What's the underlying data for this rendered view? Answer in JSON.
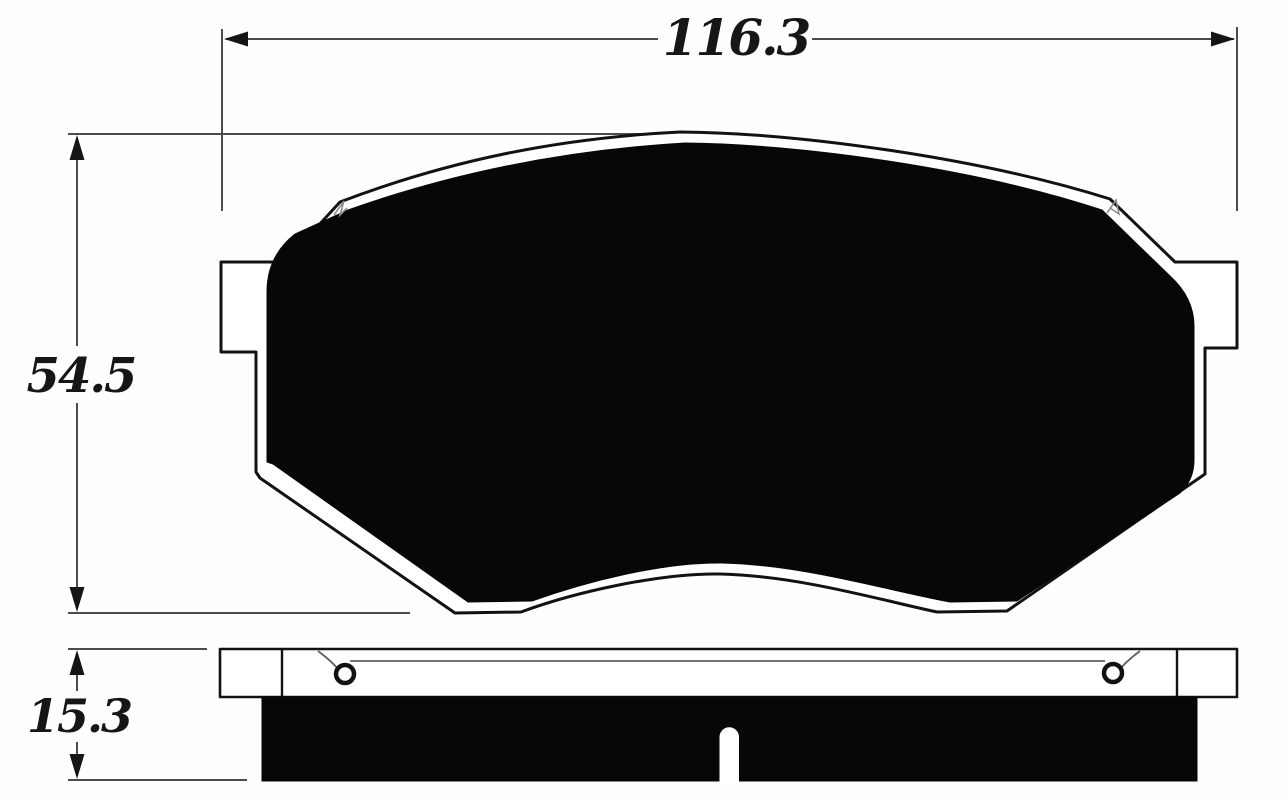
{
  "diagram": {
    "dimensions": {
      "overall_width": "116.3",
      "overall_height": "54.5",
      "thickness": "15.3"
    },
    "colors": {
      "background": "#fefefe",
      "part_outline": "#121212",
      "friction_fill": "#070707",
      "dimension_lines": "#4c4c4c",
      "label_text": "#161616"
    }
  }
}
